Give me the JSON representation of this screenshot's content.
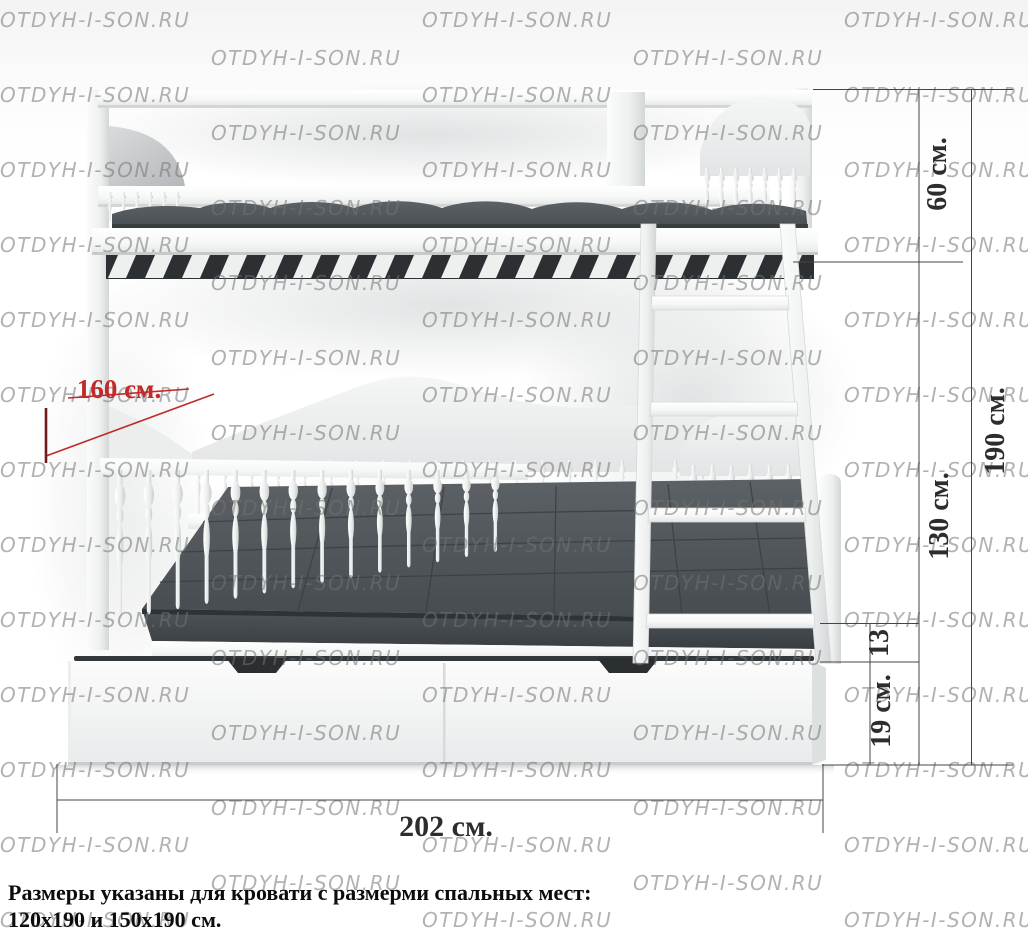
{
  "watermark": {
    "text": "OTDYH-I-SON.RU",
    "color": "rgba(115,115,115,0.55)"
  },
  "dimensions": {
    "line_color": "#454545",
    "accent_color": "#c02a2a",
    "labels": {
      "bed_width": "160 см.",
      "bed_length": "202 см.",
      "upper_section_height": "60 см.",
      "under_bunk_height": "130 см.",
      "total_height": "190 см.",
      "frame_height": "13",
      "drawer_height": "19 см."
    }
  },
  "caption": {
    "line1": "Размеры указаны для кровати с размерми спальных мест:",
    "line2": "120x190 и 150x190 см."
  },
  "bed": {
    "frame_color": "#f7f8f8",
    "mattress_color": "#4e5357",
    "slat_backing_color": "#2c3033"
  }
}
